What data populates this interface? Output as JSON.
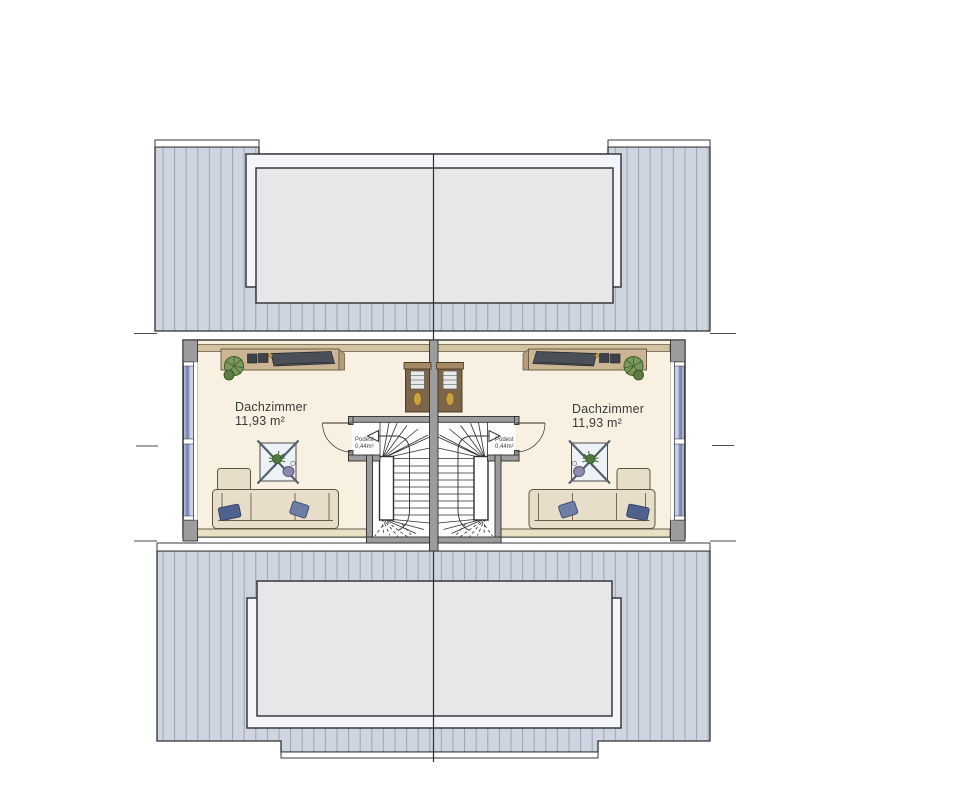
{
  "rooms": [
    {
      "name": "Dachzimmer",
      "area": "11,93 m²"
    },
    {
      "name": "Dachzimmer",
      "area": "11,93 m²"
    }
  ],
  "landings": [
    {
      "label": "Podest",
      "area": "0,44m²"
    },
    {
      "label": "Podest",
      "area": "0,44m²"
    }
  ],
  "furniture": [
    "sideboard",
    "plant",
    "wardrobe",
    "coffee-table",
    "sofa",
    "winder-staircase"
  ],
  "colors": {
    "roof_fill": "#cfd5e0",
    "roof_stripe": "#99a1b0",
    "dormer_glass": "#e7e7ea",
    "dormer_frame": "#f3f5fb",
    "floor": "#f8f1e1",
    "wall_grey": "#9c9c9c",
    "window_blue": "#aab4d6",
    "knee_wall": "#d2c29f",
    "wood": "#cbb595",
    "sofa": "#e7deca",
    "pillow": "#50618d",
    "plant": "#6f8f56",
    "line": "#2f2f2f"
  }
}
